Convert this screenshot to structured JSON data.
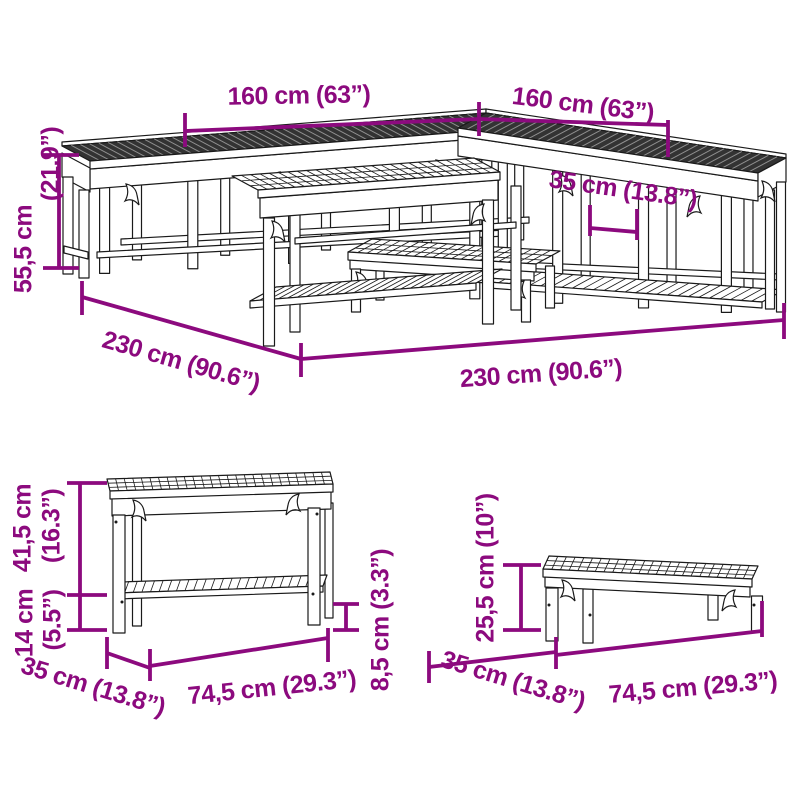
{
  "colors": {
    "dimension_annotation": "#8C0A7E",
    "line_art": "#1A1A1A",
    "dark_slat_top": "#333333",
    "background": "#FFFFFF"
  },
  "main_set": {
    "back_left_length": "160 cm (63”)",
    "back_right_length": "160 cm (63”)",
    "bench_depth": "35 cm (13.8”)",
    "total_height": {
      "line1": "55,5 cm",
      "line2": "(21.9”)"
    },
    "side_depth_total": "230 cm (90.6”)",
    "front_width_total": "230 cm (90.6”)"
  },
  "shelf_bench": {
    "upper_height": {
      "line1": "41,5 cm",
      "line2": "(16.3”)"
    },
    "shelf_height": {
      "line1": "14 cm",
      "line2": "(5.5”)"
    },
    "depth": "35 cm (13.8”)",
    "width": "74,5 cm (29.3”)",
    "shelf_clearance": "8,5 cm (3.3”)"
  },
  "low_bench": {
    "height": "25,5 cm (10”)",
    "depth": "35 cm (13.8”)",
    "width": "74,5 cm (29.3”)"
  }
}
